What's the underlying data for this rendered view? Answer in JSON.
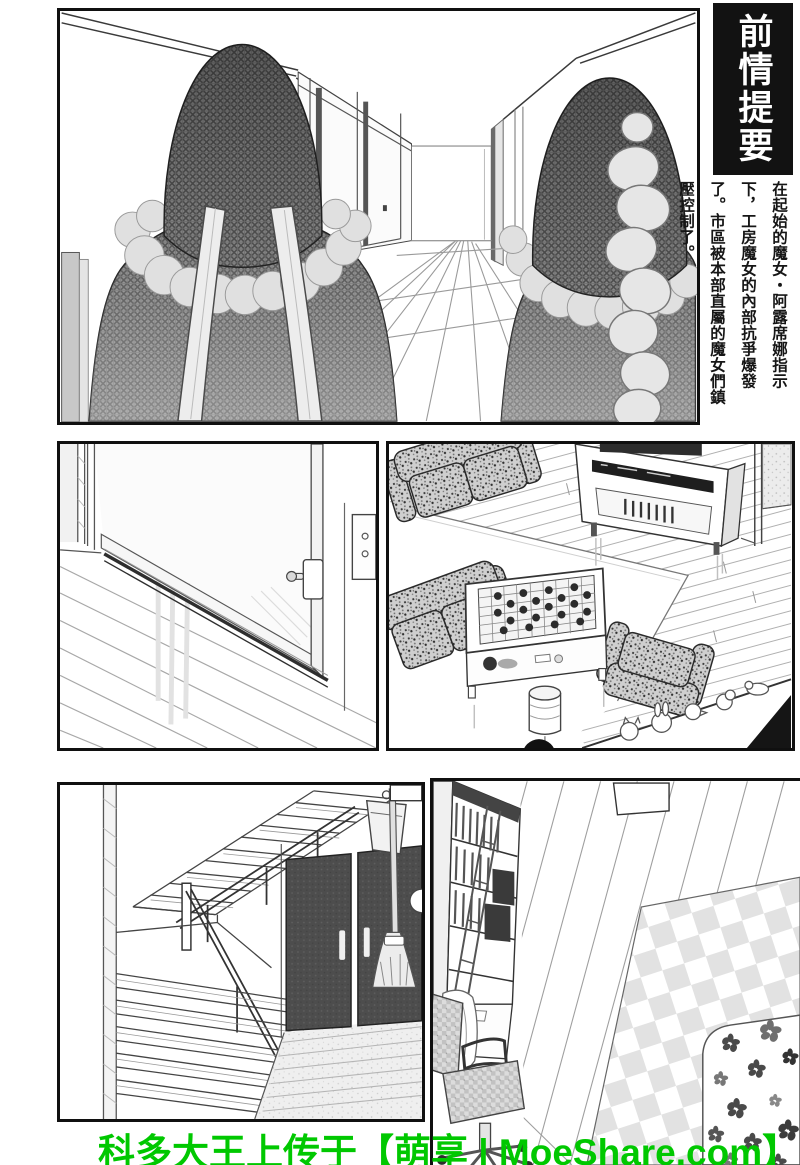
{
  "recap": {
    "title": "前情提要",
    "body": "在起始的魔女・阿露席娜指示下，工房魔女的內部抗爭爆發了。市區被本部直屬的魔女們鎮壓控制了。",
    "title_bg": "#121212",
    "title_color": "#ffffff"
  },
  "watermark": {
    "text": "科多大王上传于【萌享 | MoeShare.com】",
    "color": "#00c800"
  },
  "colors": {
    "panel_border": "#101010",
    "cloak_gray": "#8a8a8a",
    "dark_door": "#4d4d4d",
    "fur_gray": "#e0e0e0",
    "checker_rug": "#e2e2e2"
  },
  "scenes": [
    {
      "name": "hallway-two-hooded-witches"
    },
    {
      "name": "sliding-door-with-lock"
    },
    {
      "name": "living-room-sofas-game-table"
    },
    {
      "name": "staircase-dark-doors-broom"
    },
    {
      "name": "study-bookshelf-chair-checker-rug"
    }
  ]
}
